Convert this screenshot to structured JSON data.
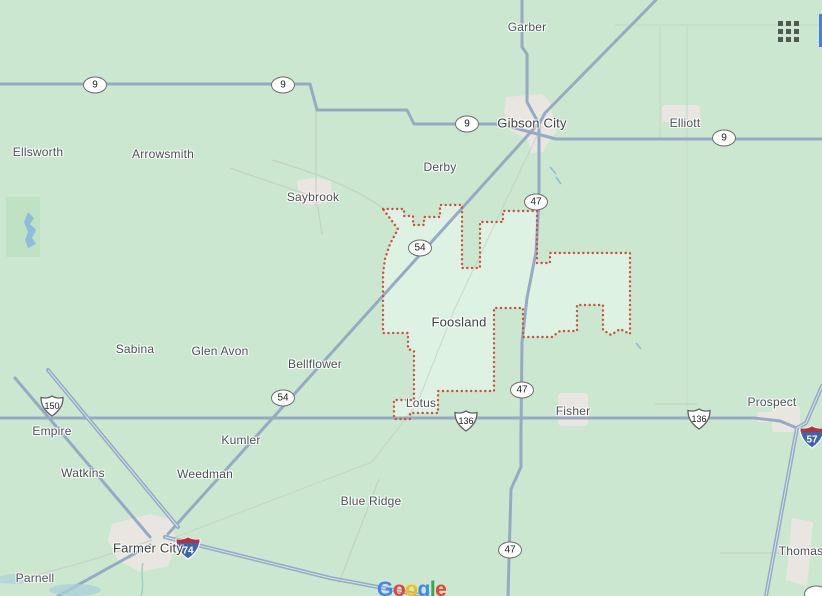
{
  "map": {
    "palette": {
      "background": "#cbe7d0",
      "region_fill": "#def2e3",
      "region_border": "#cc5140",
      "road": "#95aac3",
      "urban": "#e9e6e2",
      "water": "#8fbbdd"
    },
    "region": {
      "name": "Foosland"
    },
    "labels": [
      {
        "text": "Garber",
        "x": 527,
        "y": 27,
        "big": false
      },
      {
        "text": "Gibson City",
        "x": 532,
        "y": 123,
        "big": true
      },
      {
        "text": "Elliott",
        "x": 685,
        "y": 123,
        "big": false
      },
      {
        "text": "Ellsworth",
        "x": 38,
        "y": 152,
        "big": false
      },
      {
        "text": "Arrowsmith",
        "x": 163,
        "y": 154,
        "big": false
      },
      {
        "text": "Derby",
        "x": 440,
        "y": 167,
        "big": false
      },
      {
        "text": "Saybrook",
        "x": 313,
        "y": 197,
        "big": false
      },
      {
        "text": "Foosland",
        "x": 459,
        "y": 322,
        "big": true
      },
      {
        "text": "Sabina",
        "x": 135,
        "y": 349,
        "big": false
      },
      {
        "text": "Glen Avon",
        "x": 220,
        "y": 351,
        "big": false
      },
      {
        "text": "Bellflower",
        "x": 315,
        "y": 364,
        "big": false
      },
      {
        "text": "Lotus",
        "x": 421,
        "y": 403,
        "big": false
      },
      {
        "text": "Fisher",
        "x": 573,
        "y": 411,
        "big": false
      },
      {
        "text": "Prospect",
        "x": 772,
        "y": 402,
        "big": false
      },
      {
        "text": "Empire",
        "x": 52,
        "y": 431,
        "big": false
      },
      {
        "text": "Kumler",
        "x": 241,
        "y": 440,
        "big": false
      },
      {
        "text": "Watkins",
        "x": 83,
        "y": 473,
        "big": false
      },
      {
        "text": "Weedman",
        "x": 205,
        "y": 474,
        "big": false
      },
      {
        "text": "Blue Ridge",
        "x": 371,
        "y": 501,
        "big": false
      },
      {
        "text": "Farmer City",
        "x": 148,
        "y": 548,
        "big": true
      },
      {
        "text": "Parnell",
        "x": 35,
        "y": 578,
        "big": false
      },
      {
        "text": "Thomas",
        "x": 801,
        "y": 551,
        "big": false
      }
    ],
    "shields": [
      {
        "type": "state",
        "label": "9",
        "x": 95,
        "y": 85
      },
      {
        "type": "state",
        "label": "9",
        "x": 283,
        "y": 85
      },
      {
        "type": "state",
        "label": "9",
        "x": 467,
        "y": 124
      },
      {
        "type": "state",
        "label": "9",
        "x": 724,
        "y": 138
      },
      {
        "type": "state",
        "label": "47",
        "x": 536,
        "y": 202
      },
      {
        "type": "state",
        "label": "47",
        "x": 522,
        "y": 390
      },
      {
        "type": "state",
        "label": "47",
        "x": 510,
        "y": 550
      },
      {
        "type": "state",
        "label": "54",
        "x": 420,
        "y": 248
      },
      {
        "type": "state",
        "label": "54",
        "x": 283,
        "y": 398
      },
      {
        "type": "us",
        "label": "150",
        "x": 52,
        "y": 406
      },
      {
        "type": "us",
        "label": "136",
        "x": 466,
        "y": 421
      },
      {
        "type": "us",
        "label": "136",
        "x": 699,
        "y": 419
      },
      {
        "type": "interstate",
        "label": "74",
        "x": 188,
        "y": 548
      },
      {
        "type": "interstate",
        "label": "57",
        "x": 812,
        "y": 437
      },
      {
        "type": "state",
        "label": "",
        "x": 816,
        "y": 594
      }
    ],
    "logo": {
      "letters": [
        {
          "ch": "G",
          "color": "#4285F4"
        },
        {
          "ch": "o",
          "color": "#EA4335"
        },
        {
          "ch": "o",
          "color": "#FBBC05"
        },
        {
          "ch": "g",
          "color": "#4285F4"
        },
        {
          "ch": "l",
          "color": "#34A853"
        },
        {
          "ch": "e",
          "color": "#EA4335"
        }
      ]
    }
  }
}
